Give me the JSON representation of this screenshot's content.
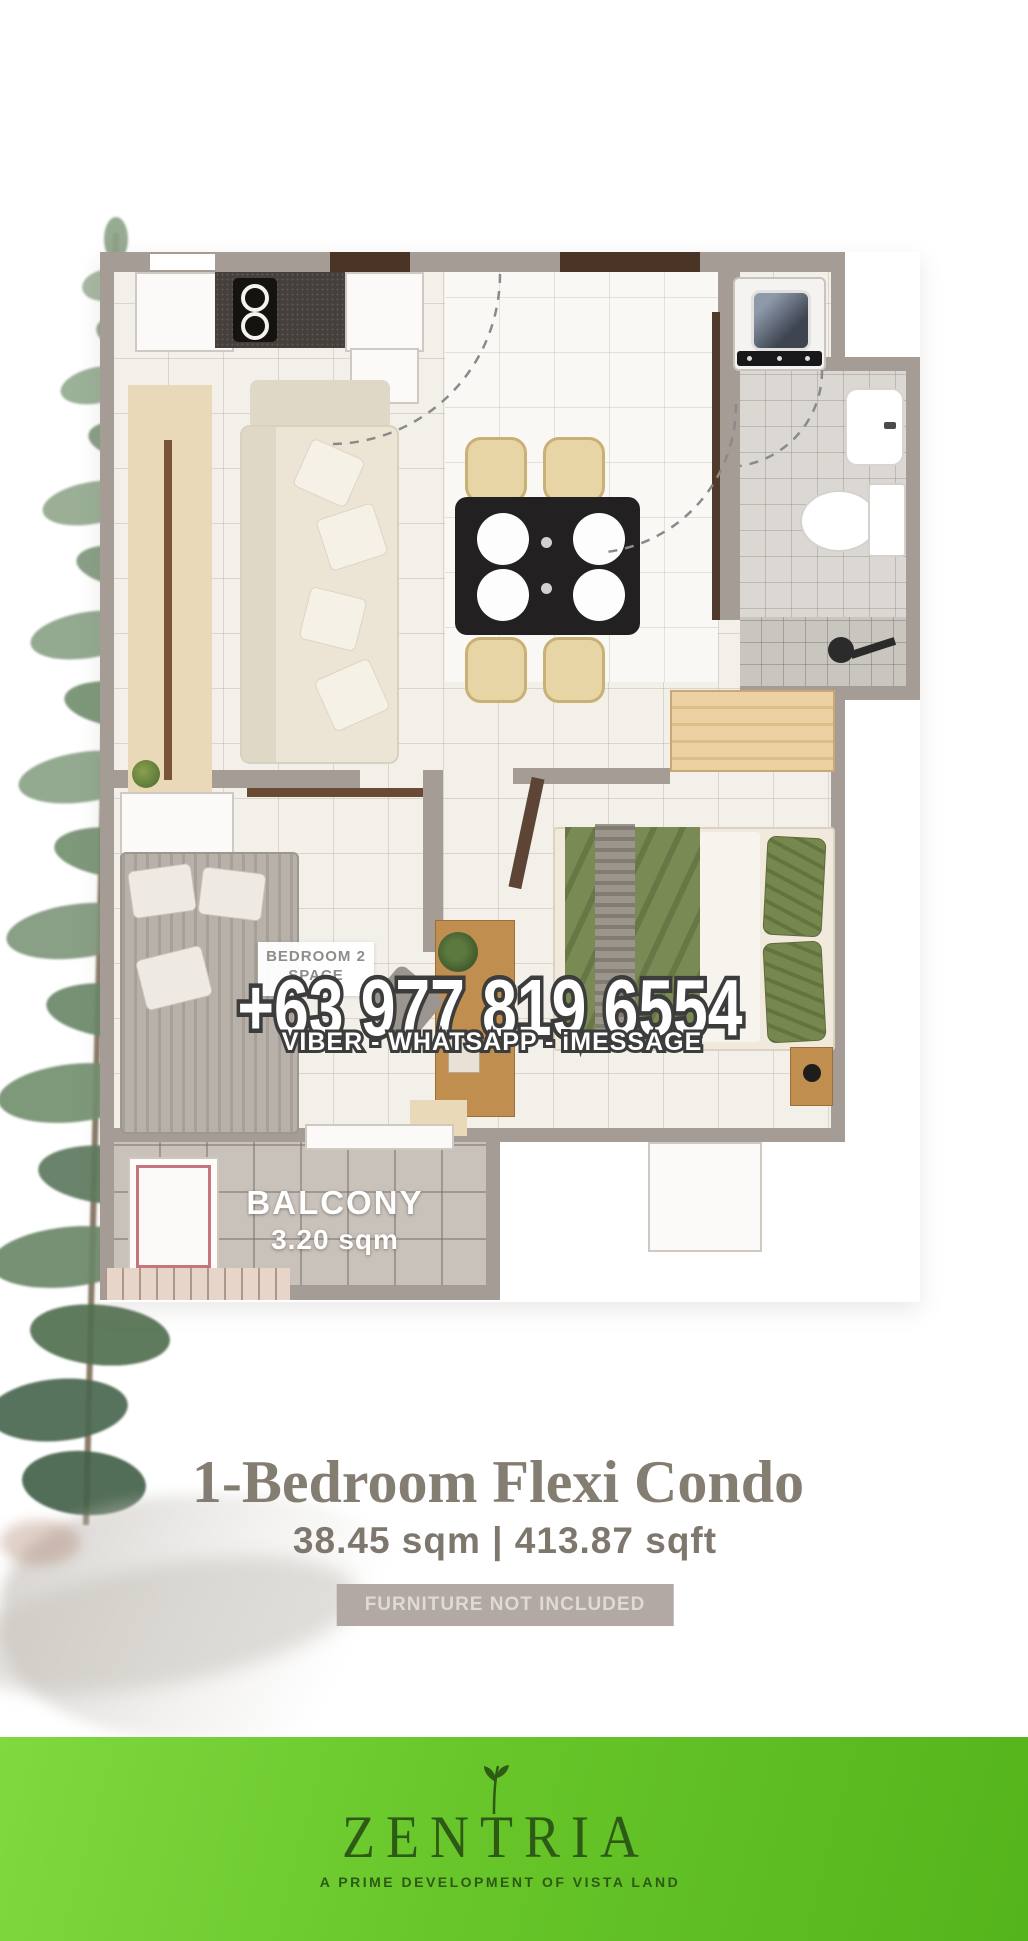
{
  "contact": {
    "phone": "+63 977 819 6554",
    "channels": "VIBER - WHATSAPP - iMESSAGE"
  },
  "floorplan": {
    "bedroom2_label_line1": "BEDROOM 2",
    "bedroom2_label_line2": "SPACE",
    "balcony_label": "BALCONY",
    "balcony_area": "3.20 sqm"
  },
  "unit": {
    "title": "1-Bedroom Flexi Condo",
    "area": "38.45 sqm | 413.87 sqft",
    "disclaimer": "FURNITURE NOT INCLUDED"
  },
  "brand": {
    "name": "ZENTRIA",
    "tagline": "A PRIME DEVELOPMENT OF VISTA LAND"
  },
  "colors": {
    "footer_green": "#68c62a",
    "logo_green": "#2d5a15",
    "wall_gray": "#a59c96",
    "title_gray": "#847d72",
    "badge_bg": "#b2a8a4",
    "duvet_green": "#7a8a55",
    "balcony_tile": "#c9c2ba"
  }
}
